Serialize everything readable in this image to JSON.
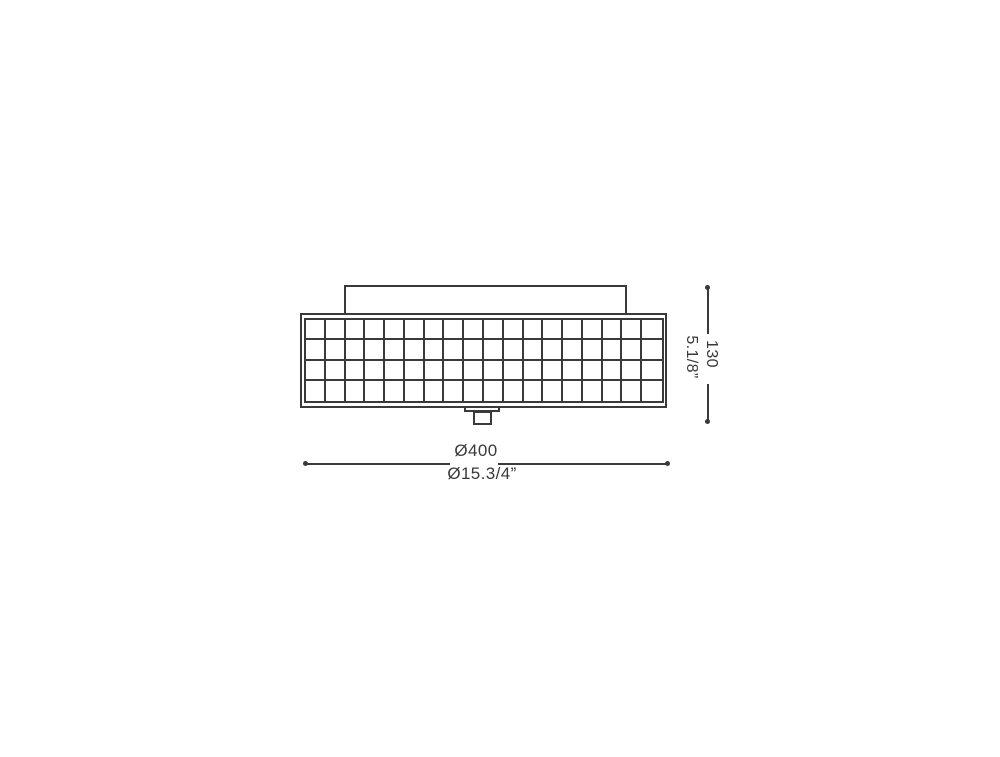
{
  "figure": {
    "type": "technical-drawing",
    "subject": "ceiling-lamp-front-elevation",
    "line_color": "#3a3a3a",
    "text_color": "#3a3a3a",
    "grid": {
      "columns": 18,
      "rows": 4
    }
  },
  "dimensions": {
    "height_mm": "130",
    "height_in": "5.1/8”",
    "diameter_mm": "Ø400",
    "diameter_in": "Ø15.3/4”"
  }
}
